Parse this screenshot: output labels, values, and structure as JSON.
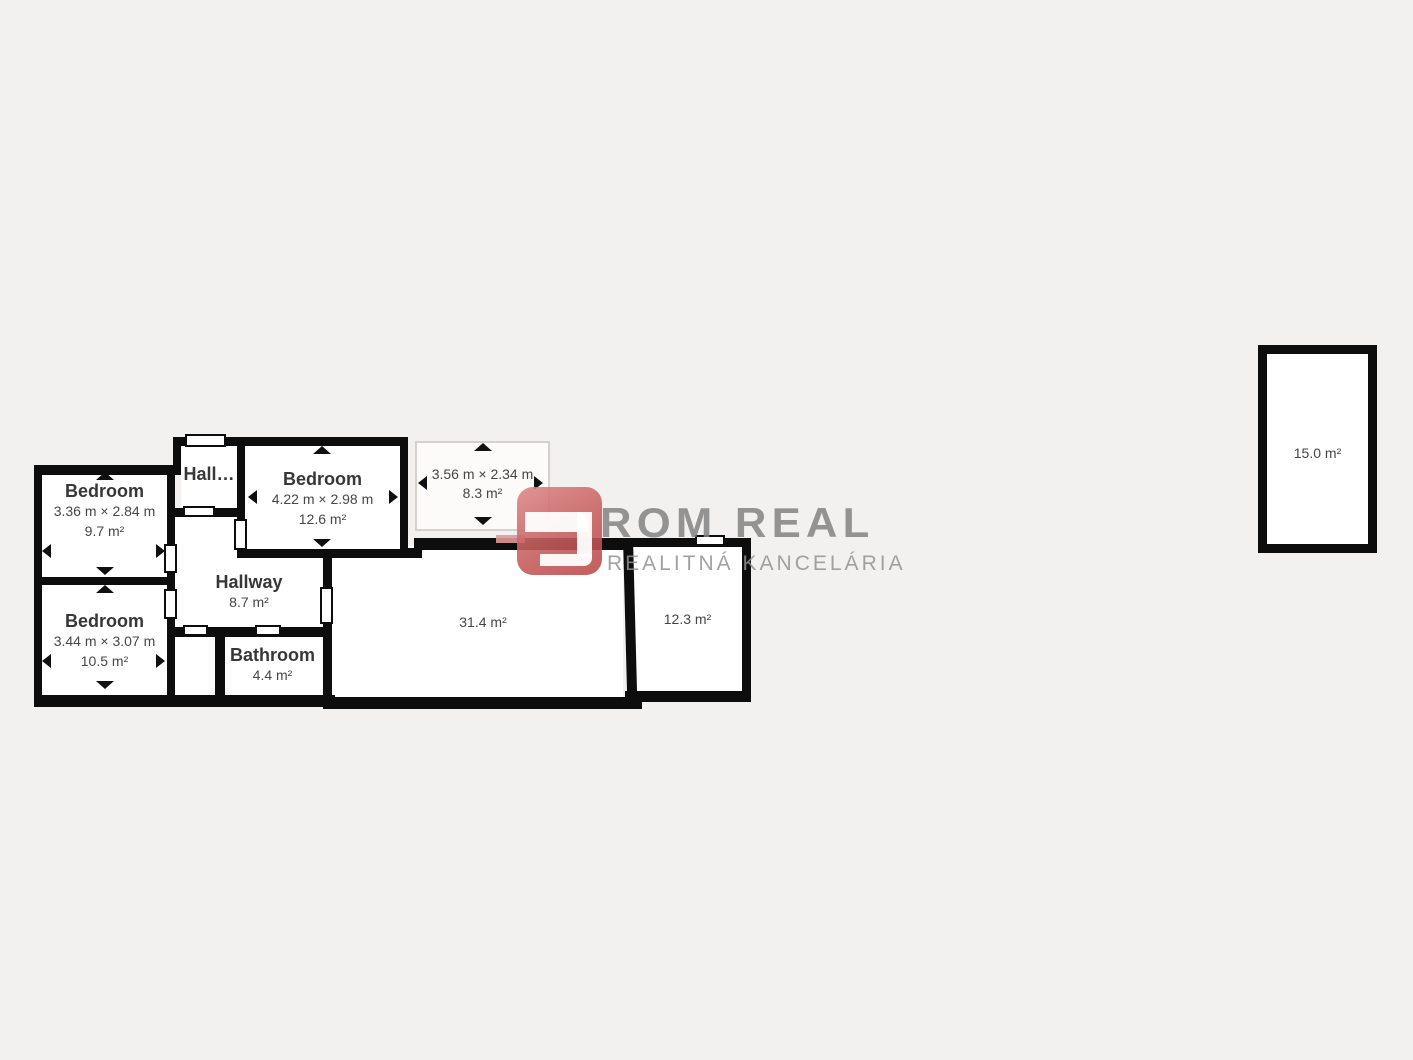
{
  "canvas": {
    "background": "#f3f1ef",
    "wall_color": "#0d0d0d",
    "room_fill": "#ffffff"
  },
  "rooms": {
    "bedroom_a": {
      "name": "Bedroom",
      "dimensions": "3.36 m × 2.84 m",
      "area": "9.7 m²"
    },
    "bedroom_b": {
      "name": "Bedroom",
      "dimensions": "3.44 m × 3.07 m",
      "area": "10.5 m²"
    },
    "hall_small": {
      "name": "Hall…"
    },
    "bedroom_c": {
      "name": "Bedroom",
      "dimensions": "4.22 m × 2.98 m",
      "area": "12.6 m²"
    },
    "hallway": {
      "name": "Hallway",
      "area": "8.7 m²"
    },
    "bathroom": {
      "name": "Bathroom",
      "area": "4.4 m²"
    },
    "balcony": {
      "dimensions": "3.56 m × 2.34 m",
      "area": "8.3 m²"
    },
    "living_room": {
      "area": "31.4 m²"
    },
    "room_right": {
      "area": "12.3 m²"
    },
    "detached_room": {
      "area": "15.0 m²"
    }
  },
  "watermark": {
    "brand": "ROM REAL",
    "subtitle": "REALITNÁ KANCELÁRIA",
    "logo_red": "#c45858",
    "text_gray": "#8b8b8b"
  }
}
